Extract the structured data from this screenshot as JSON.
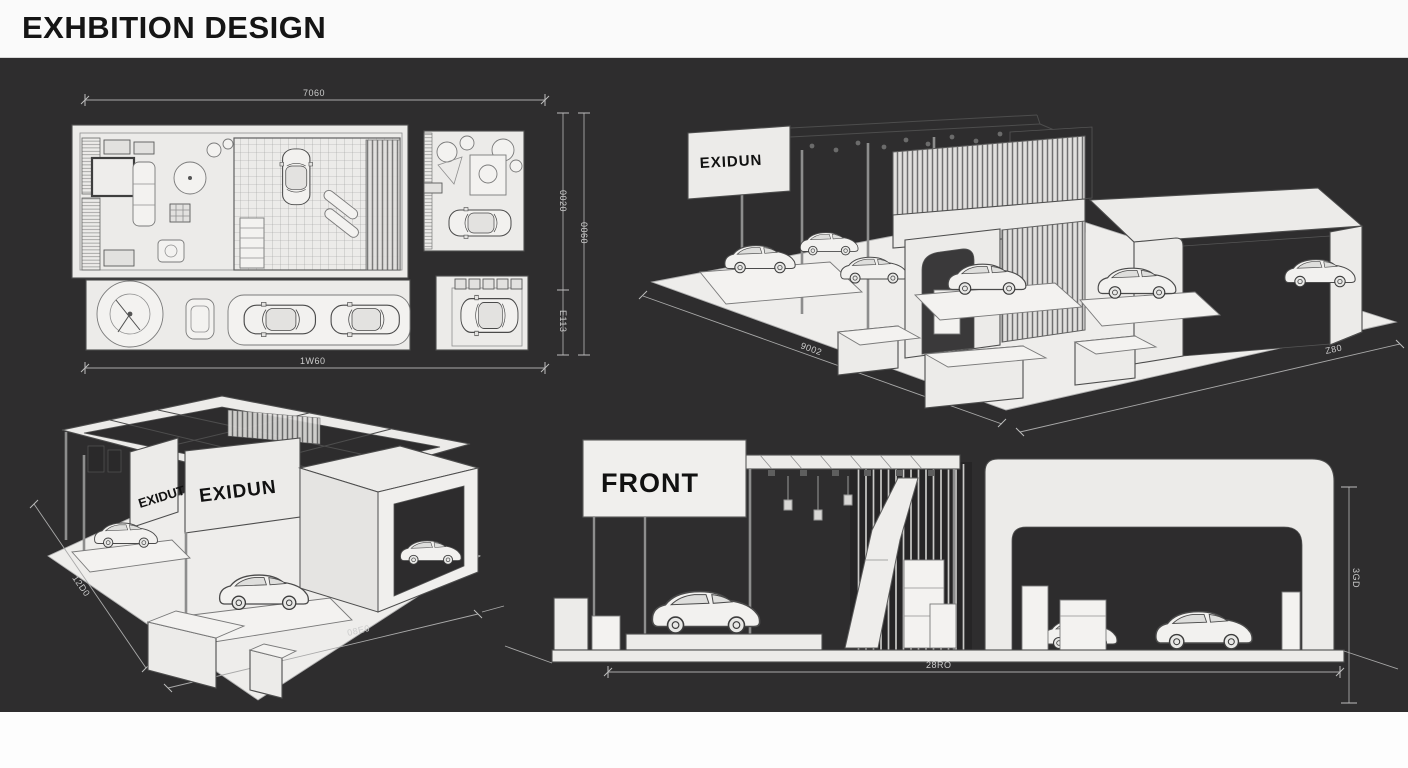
{
  "header": {
    "title": "EXHBITION DESIGN"
  },
  "colors": {
    "background": "#2e2d2e",
    "header_bg": "#fafafa",
    "drawing_paper": "#ecebe9",
    "line": "#4d4d4d",
    "dimension_line": "#a9a9a9"
  },
  "views": {
    "floor_plan": {
      "dims": {
        "top": "7060",
        "bottom": "1W60",
        "right_inner_top": "0020",
        "right_inner_bottom": "E113",
        "right_outer": "0060"
      }
    },
    "iso_main": {
      "sign": "EXIDUN",
      "dims": {
        "left": "9002",
        "right": "Z80"
      }
    },
    "iso_alt": {
      "sign_side": "EXIDUT",
      "sign_front": "EXIDUN",
      "dims": {
        "left": "12D0",
        "bottom": "08E0"
      }
    },
    "front_elevation": {
      "label": "FRONT",
      "dims": {
        "bottom": "28RO",
        "right": "3GD"
      }
    }
  }
}
